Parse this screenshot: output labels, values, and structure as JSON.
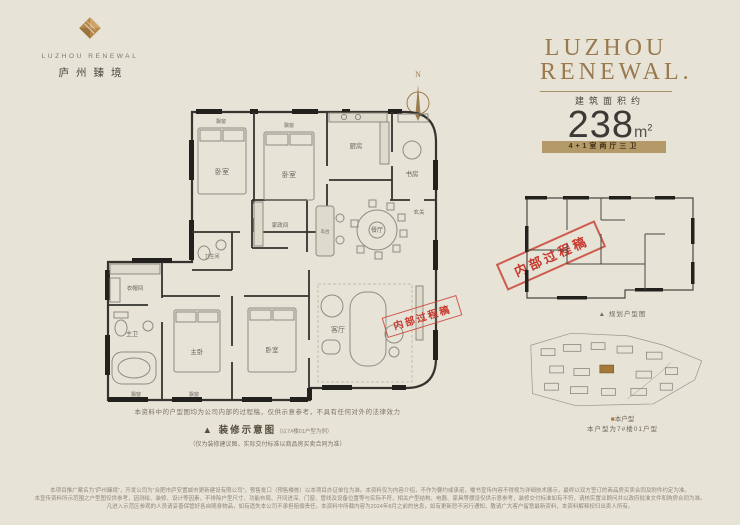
{
  "brand": {
    "logo_en": "LUZHOU RENEWAL",
    "logo_cn": "庐州臻境"
  },
  "headline": {
    "line1": "LUZHOU",
    "line2": "RENEWAL."
  },
  "compass": {
    "letter": "N"
  },
  "spec": {
    "area_label": "建筑面积约",
    "area_value": "238",
    "area_unit": "m",
    "area_sup": "2",
    "layout_badge": "4+1室两厅三卫"
  },
  "floorplan": {
    "labels": {
      "bay_top_left": "飘窗",
      "bay_top_right": "飘窗",
      "bedroom_a": "卧室",
      "bedroom_b": "卧室",
      "kitchen": "厨房",
      "study": "书房",
      "bathroom": "卫生间",
      "utility": "家政间",
      "island": "岛台",
      "dining": "餐厅",
      "hall": "玄关",
      "closet": "衣帽间",
      "master_bathroom": "主卫",
      "master_bedroom": "主卧",
      "bedroom_c": "卧室",
      "living": "客厅",
      "bay_bottom_left": "飘窗",
      "bay_bottom_right": "飘窗"
    }
  },
  "stamp": {
    "text": "内部过程稿"
  },
  "notes": {
    "line1": "本资料中的户型图均为公司内部的过程稿，仅供示意参考，不具有任何对外的法律效力",
    "marker": "▲ ",
    "caption": "装修示意图",
    "caption_sub": "（以7#楼01户型为例）",
    "line2": "（仅为装修建议图，实际交付标准以商品房买卖合同为准）"
  },
  "mini_plan": {
    "marker": "▲ ",
    "caption": "规划户型图"
  },
  "site_plan": {
    "legend_marker": "■",
    "legend_label": "本户型",
    "caption": "本户型为7#楼01户型"
  },
  "disclaimer": {
    "line1": "本项目推广案名为“庐州臻境”，开发公司为“合肥市庐安置城市更新建设有限公司”，预售批口（预售楼栋）以本项目办证单位为准。本资料仅为内容介绍，不作为要约或承诺，楼书宣传内容不得视为详细技术展示，最终以双方签订的商品房买卖合同及附件约定为准。",
    "line2": "本宣传资料所示范围之户型图仅供参考，因测绘、装修、设计等因素，不排除户型尺寸、功能布局、开间进深、门窗、管线及设备位置等与实际不符，相关户型结构、电器、家具等摆设仅供示意参考，装修交付标准如有不符，请核实置业顾问并以政府批准文件和购房合同为准。",
    "line3": "凡进入示范区参观的人员请妥善保管好各自随身物品，如有遗失本公司不承担赔偿责任。本资料中所载内容为2024年8月之前的信息，如有更新恕不另行通知，敬请广大客户留意最新资料，本资料解释权归出卖人所有。"
  }
}
